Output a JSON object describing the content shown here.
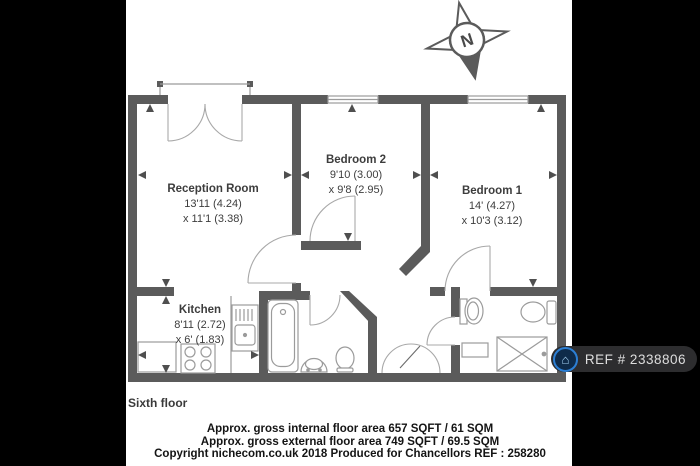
{
  "compass": {
    "label": "N"
  },
  "rooms": [
    {
      "name": "Reception Room",
      "dim1": "13'11 (4.24)",
      "dim2": "x 11'1 (3.38)"
    },
    {
      "name": "Bedroom 2",
      "dim1": "9'10 (3.00)",
      "dim2": "x 9'8 (2.95)"
    },
    {
      "name": "Bedroom 1",
      "dim1": "14' (4.27)",
      "dim2": "x 10'3 (3.12)"
    },
    {
      "name": "Kitchen",
      "dim1": "8'11 (2.72)",
      "dim2": "x 6' (1.83)"
    }
  ],
  "floor_label": "Sixth floor",
  "footer": {
    "line1": "Approx. gross internal floor area 657 SQFT / 61 SQM",
    "line2": "Approx. gross external floor area 749 SQFT / 69.5 SQM",
    "line3": "Copyright nichecom.co.uk 2018 Produced for Chancellors REF : 258280"
  },
  "badge": {
    "ref": "REF # 2338806"
  },
  "colors": {
    "wall": "#5b5b5b",
    "fixture_line": "#9b9b9b",
    "badge_bg": "#2d2d2f",
    "badge_accent": "#2c7fd4",
    "text": "#3d3d3d"
  }
}
